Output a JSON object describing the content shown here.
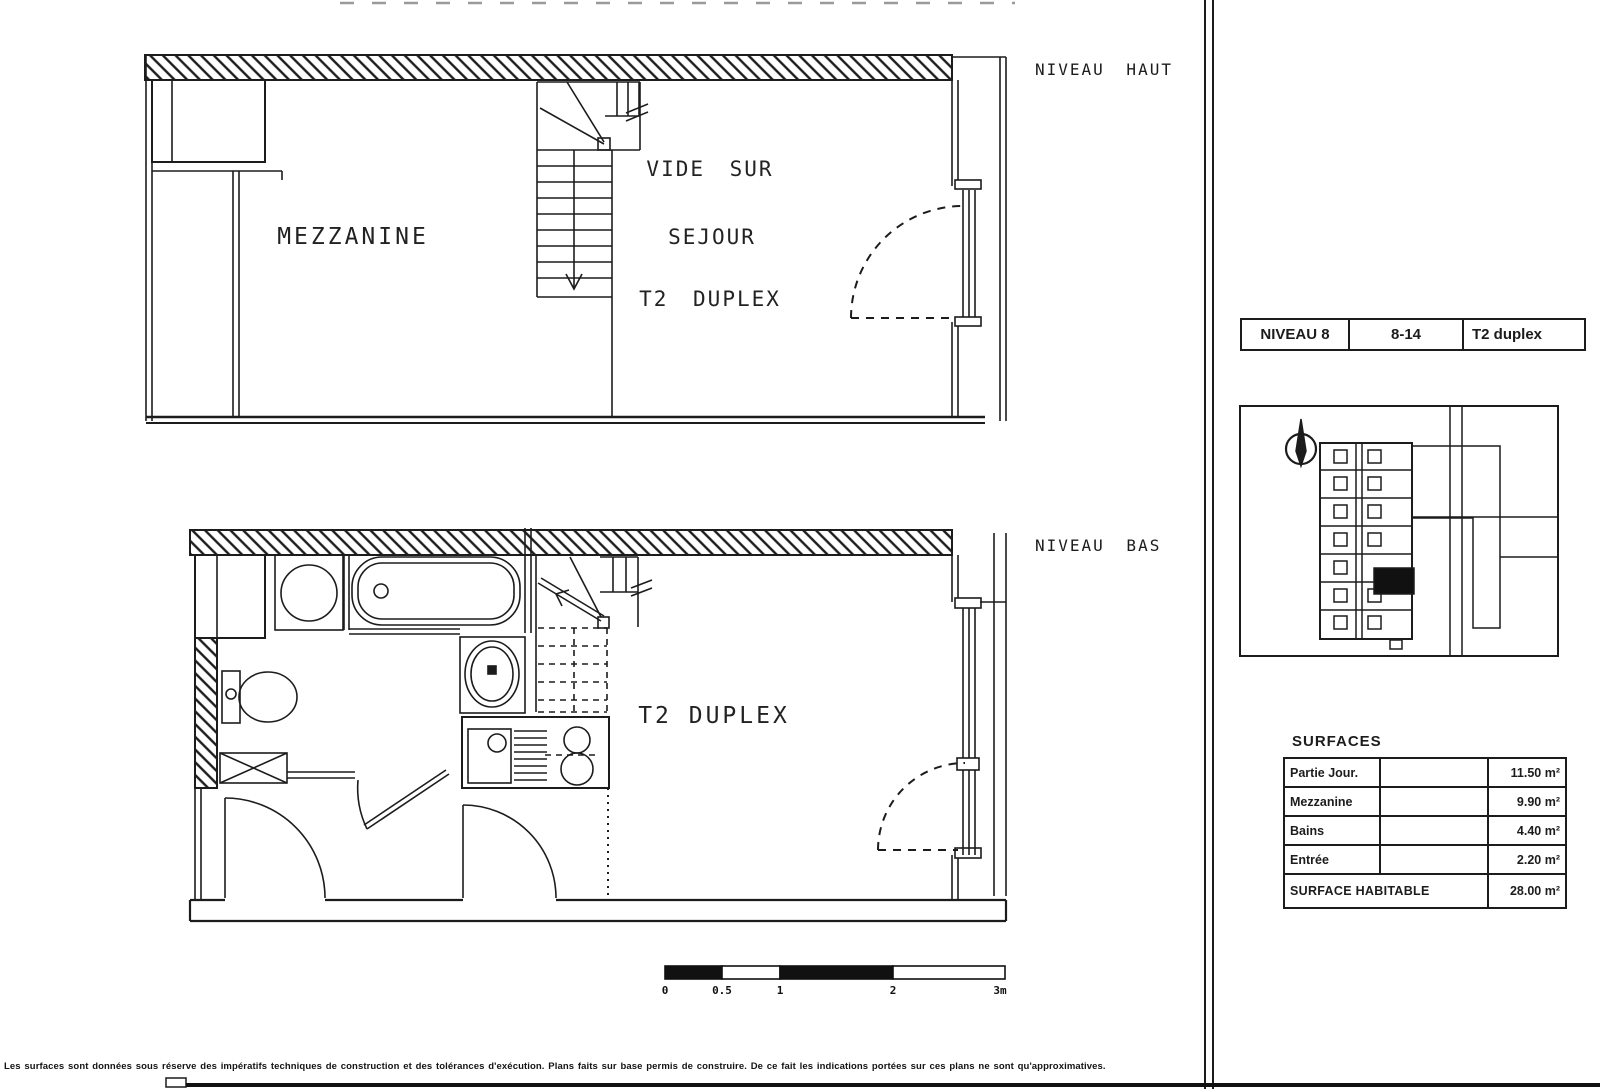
{
  "upper_plan": {
    "level_label": "NIVEAU HAUT",
    "mezzanine_label": "MEZZANINE",
    "void_label_line1": "VIDE SUR",
    "void_label_line2": "SEJOUR",
    "void_label_line3": "T2 DUPLEX"
  },
  "lower_plan": {
    "level_label": "NIVEAU BAS",
    "room_label": "T2 DUPLEX"
  },
  "scale_bar": {
    "ticks": [
      "0",
      "0.5",
      "1",
      "2",
      "3m"
    ]
  },
  "unit_header": {
    "level": "NIVEAU 8",
    "unit_number": "8-14",
    "unit_type": "T2 duplex"
  },
  "surfaces": {
    "title": "SURFACES",
    "rows": [
      {
        "label": "Partie Jour.",
        "value": "11.50 m²"
      },
      {
        "label": "Mezzanine",
        "value": "9.90 m²"
      },
      {
        "label": "Bains",
        "value": "4.40 m²"
      },
      {
        "label": "Entrée",
        "value": "2.20 m²"
      }
    ],
    "total_label": "SURFACE HABITABLE",
    "total_value": "28.00 m²"
  },
  "footer_disclaimer": "Les surfaces sont données sous réserve des impératifs techniques de construction et des tolérances d'exécution. Plans faits sur base permis de construire. De ce fait les indications portées sur ces plans ne sont qu'approximatives.",
  "colors": {
    "ink": "#1c1c1c",
    "paper": "#ffffff",
    "highlighted_unit": "#111111"
  }
}
